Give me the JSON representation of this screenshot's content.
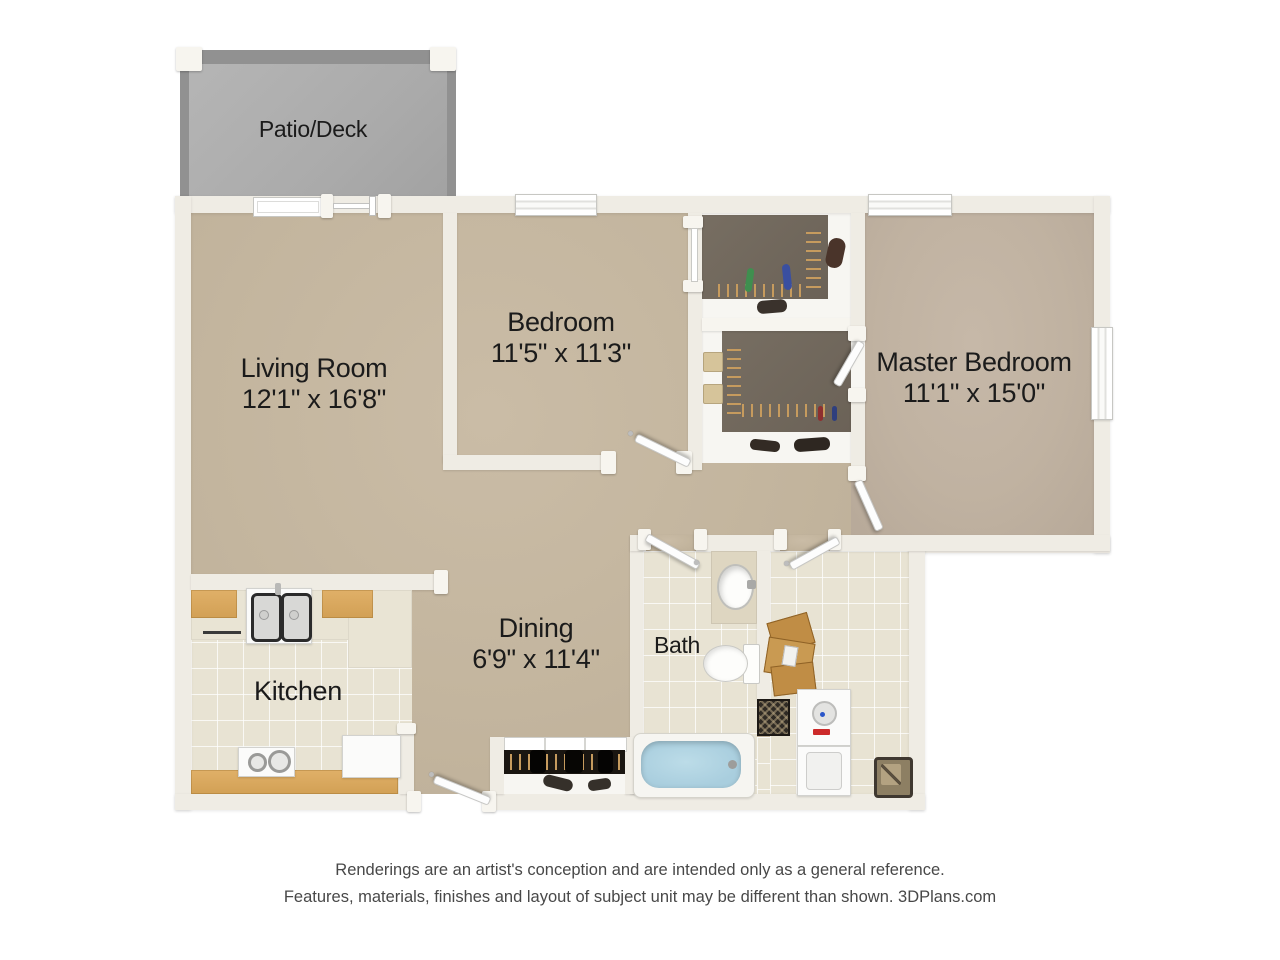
{
  "colors": {
    "page_bg": "#ffffff",
    "wall": "#efece4",
    "carpet": "#c3b59e",
    "carpet_master": "#c0b2a1",
    "tile": "#e8e3d3",
    "closet_dark": "#6b6257",
    "coat_closet_dark": "#1a1611",
    "patio_concrete": "#ababab",
    "patio_wall": "#919191",
    "wood": "#d2a055",
    "cardboard": "#c08d45",
    "tub_water": "#a9cede",
    "hanger": "#c69b5e",
    "label_text": "#1b1b1b",
    "disclaimer_text": "#484848"
  },
  "rooms": {
    "patio": {
      "label": "Patio/Deck"
    },
    "living_room": {
      "label": "Living Room",
      "dimensions": "12'1\" x 16'8\""
    },
    "bedroom": {
      "label": "Bedroom",
      "dimensions": "11'5\" x 11'3\""
    },
    "master_bedroom": {
      "label": "Master Bedroom",
      "dimensions": "11'1\" x 15'0\""
    },
    "dining": {
      "label": "Dining",
      "dimensions": "6'9\" x 11'4\""
    },
    "kitchen": {
      "label": "Kitchen"
    },
    "bath": {
      "label": "Bath"
    }
  },
  "footer": {
    "line1": "Renderings are an artist's conception and are intended only as a general reference.",
    "line2": "Features, materials, finishes and layout of subject unit may be different than shown. 3DPlans.com"
  }
}
